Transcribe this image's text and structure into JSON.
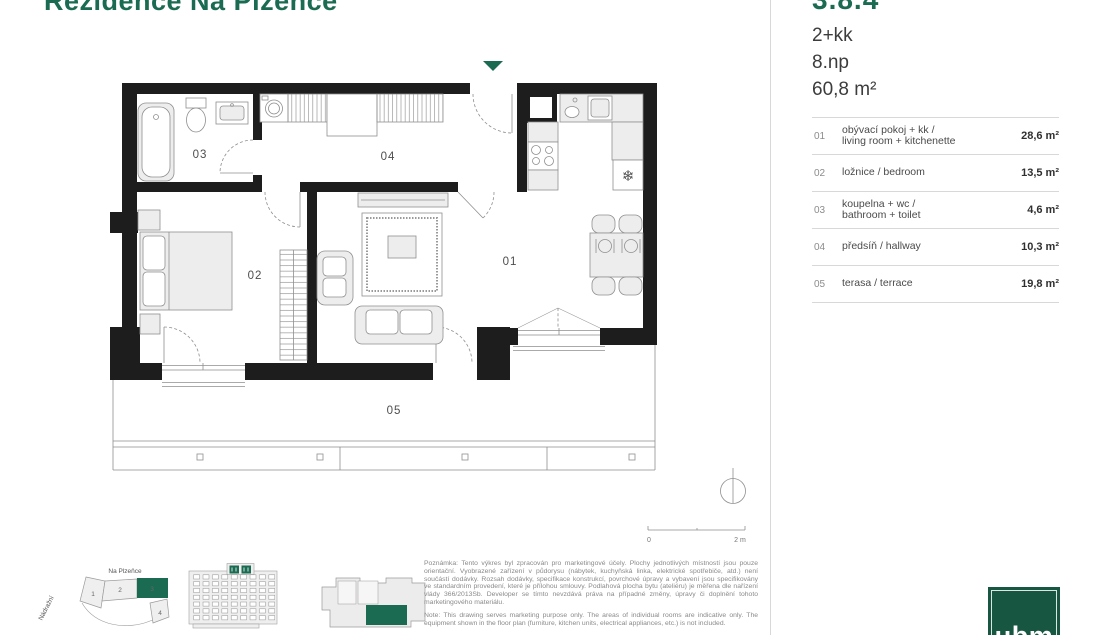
{
  "brand": {
    "green": "#1a6b52",
    "logo_green": "#175640",
    "logo_text": "ubm"
  },
  "header": {
    "project_title": "Rezidence Na Plzeňce"
  },
  "unit": {
    "number": "3.8.4",
    "layout": "2+kk",
    "floor": "8.np",
    "total_area": "60,8 m²"
  },
  "rooms": [
    {
      "number": "01",
      "name_line1": "obývací pokoj + kk /",
      "name_line2": "living room + kitchenette",
      "area": "28,6 m²"
    },
    {
      "number": "02",
      "name_line1": "ložnice / bedroom",
      "name_line2": "",
      "area": "13,5 m²"
    },
    {
      "number": "03",
      "name_line1": "koupelna + wc /",
      "name_line2": "bathroom + toilet",
      "area": "4,6 m²"
    },
    {
      "number": "04",
      "name_line1": "předsíň / hallway",
      "name_line2": "",
      "area": "10,3 m²"
    },
    {
      "number": "05",
      "name_line1": "terasa / terrace",
      "name_line2": "",
      "area": "19,8 m²"
    }
  ],
  "floorplan": {
    "labels": {
      "living": "01",
      "bedroom": "02",
      "bathroom": "03",
      "hallway": "04",
      "terrace": "05"
    },
    "scale": {
      "zero": "0",
      "max": "2 m"
    }
  },
  "site_map": {
    "street_top": "Na Plzeňce",
    "street_left": "Nádražní",
    "plots": [
      "1",
      "2",
      "3",
      "4"
    ]
  },
  "notes": {
    "cz": "Poznámka: Tento výkres byl zpracován pro marketingové účely. Plochy jednotlivých místností jsou pouze orientační. Vyobrazené zařízení v půdorysu (nábytek, kuchyňská linka, elektrické spotřebiče, atd.) není součástí dodávky. Rozsah dodávky, specifikace konstrukcí, povrchové úpravy a vybavení jsou specifikovány ve standardním provedení, které je přílohou smlouvy. Podlahová plocha bytu (ateliéru) je měřena dle nařízení vlády 366/2013Sb. Developer se tímto nevzdává práva na případné změny, úpravy či doplnění tohoto marketingového materiálu.",
    "en": "Note: This drawing serves marketing purpose only. The areas of individual rooms are indicative only. The equipment shown in the floor plan (furniture, kitchen units, electrical appliances, etc.) is not included."
  }
}
